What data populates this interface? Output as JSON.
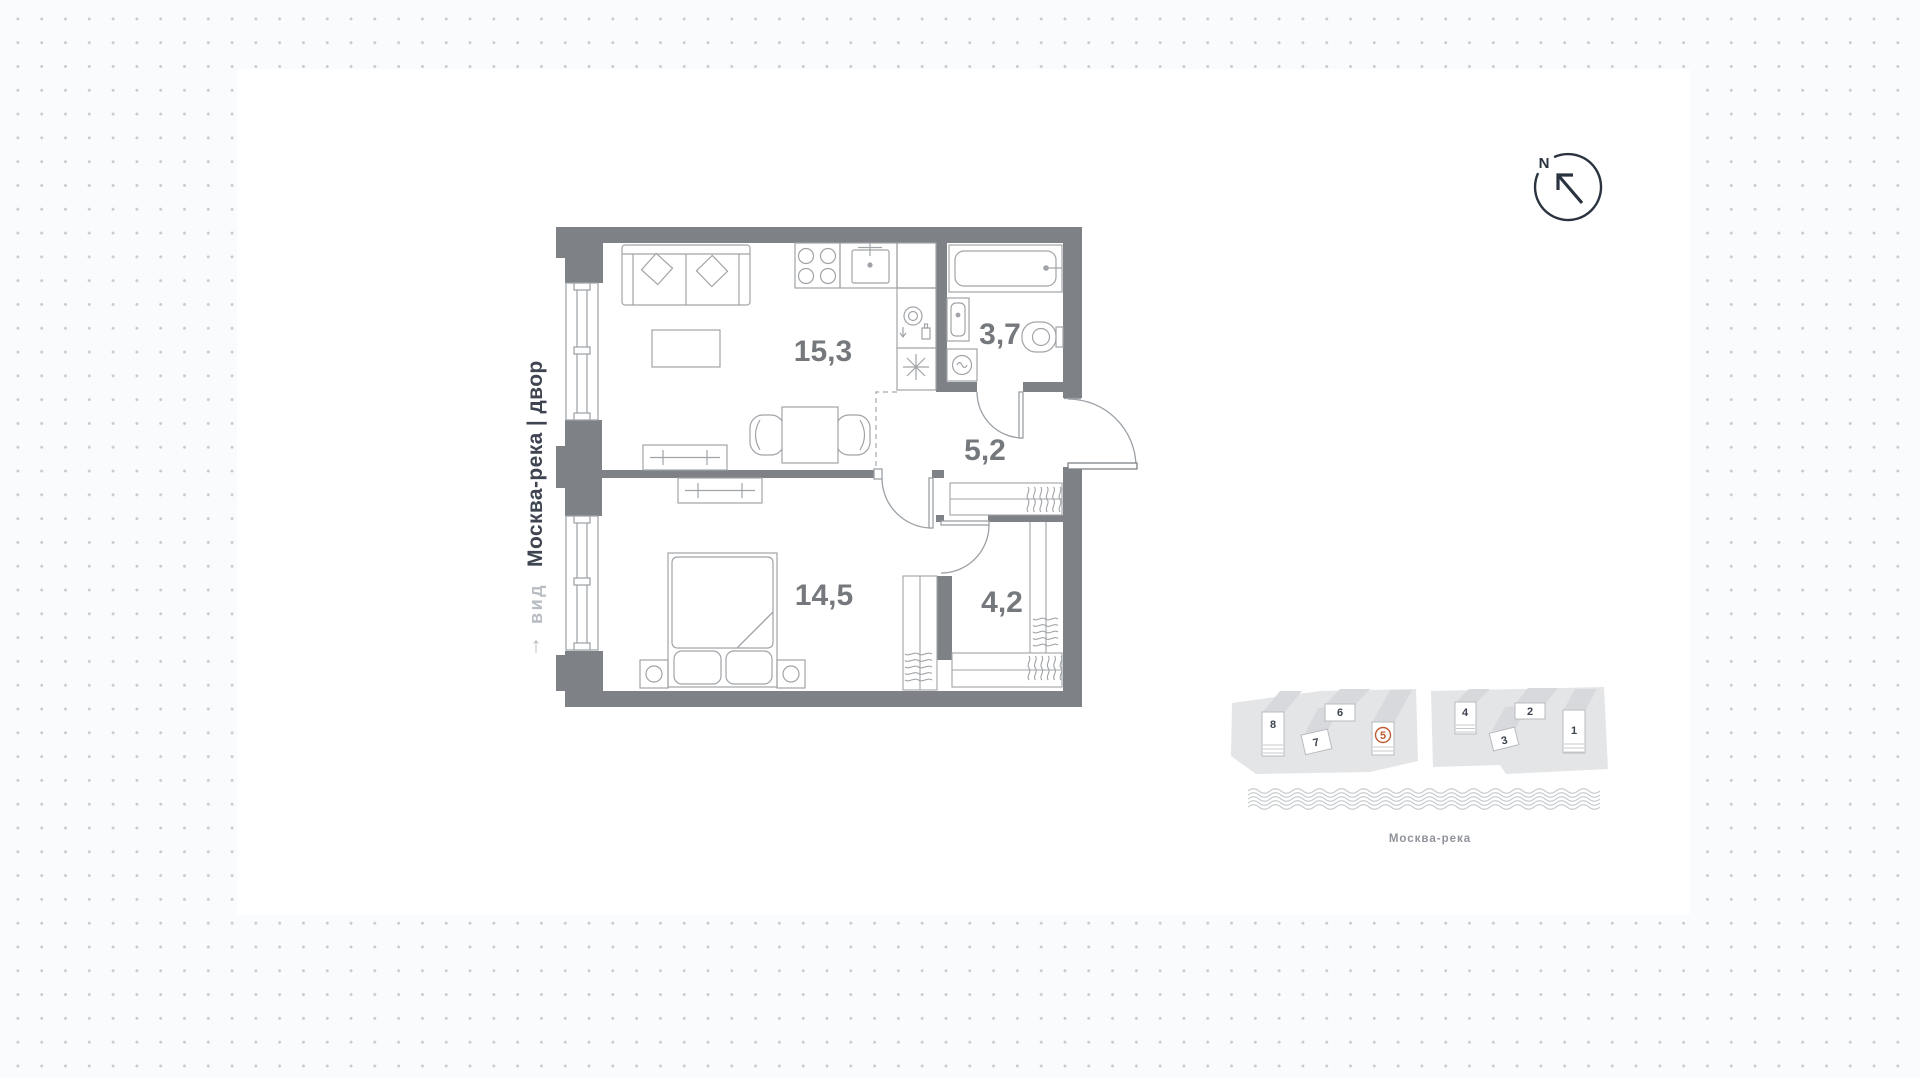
{
  "canvas": {
    "background_color": "#fafbfc",
    "dot_color": "#c9cbcd",
    "card_color": "#ffffff"
  },
  "plan": {
    "wall_color": "#7e8286",
    "furniture_color": "#a0a3a7",
    "label_color": "#75787c",
    "rooms": [
      {
        "id": "living-kitchen",
        "area": "15,3"
      },
      {
        "id": "bathroom",
        "area": "3,7"
      },
      {
        "id": "hallway",
        "area": "5,2"
      },
      {
        "id": "bedroom",
        "area": "14,5"
      },
      {
        "id": "wardrobe",
        "area": "4,2"
      }
    ]
  },
  "orientation": {
    "arrow": "↑",
    "view_label": "вид",
    "view_value": "Москва-река | двор"
  },
  "compass": {
    "north_label": "N"
  },
  "site_plan": {
    "buildings": [
      "1",
      "2",
      "3",
      "4",
      "5",
      "6",
      "7",
      "8"
    ],
    "highlighted_building": "5",
    "accent_color": "#c25a33",
    "river_label": "Москва-река"
  }
}
